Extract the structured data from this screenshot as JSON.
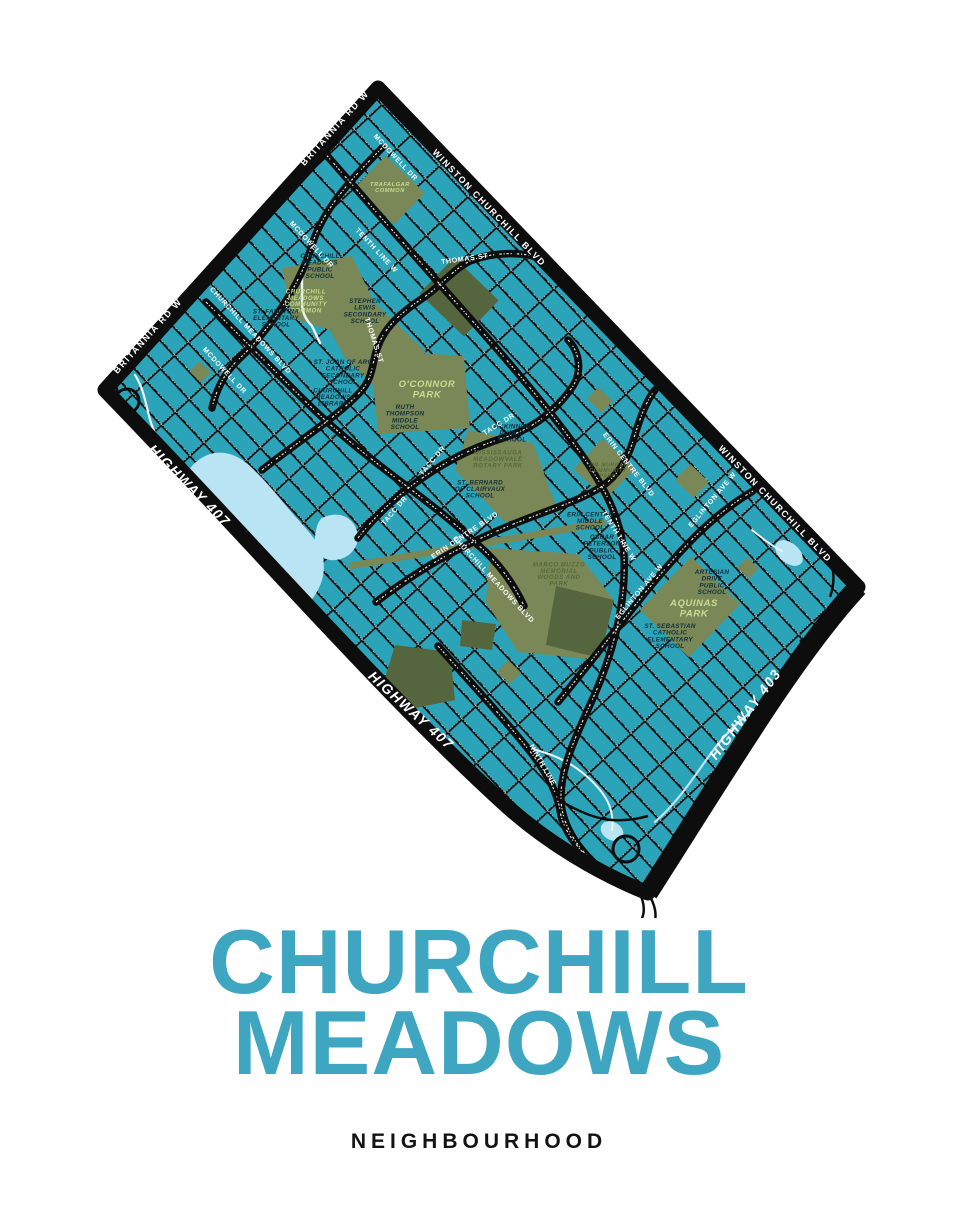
{
  "poster": {
    "title_line1": "CHURCHILL",
    "title_line2": "MEADOWS",
    "subtitle": "NEIGHBOURHOOD"
  },
  "colors": {
    "page_bg": "#FFFFFF",
    "map_water_teal": "#2BA4BA",
    "road_black": "#0D0D0D",
    "park_olive": "#7A8857",
    "park_dark_olive": "#55663E",
    "pond_light_blue": "#B9E4F4",
    "creek_white": "#EAF6FA",
    "street_label_white": "#FFFFFF",
    "school_label_dark": "#10303B",
    "park_label_light": "#C9DC8F",
    "park_label_dark": "#566A34",
    "title_teal": "#3EA6C1",
    "subtitle_black": "#121212"
  },
  "map": {
    "highway_labels": [
      {
        "text": "HIGHWAY 407",
        "x": 186,
        "y": 489,
        "rot": 45,
        "size": 14
      },
      {
        "text": "HIGHWAY 407",
        "x": 408,
        "y": 714,
        "rot": 42,
        "size": 14
      },
      {
        "text": "HIGHWAY 403",
        "x": 749,
        "y": 717,
        "rot": -53,
        "size": 14
      }
    ],
    "boundary_labels": [
      {
        "text": "BRITANNIA RD W",
        "x": 337,
        "y": 130,
        "rot": -48,
        "size": 9
      },
      {
        "text": "BRITANNIA RD W",
        "x": 150,
        "y": 338,
        "rot": -48,
        "size": 9
      },
      {
        "text": "WINSTON CHURCHILL BLVD",
        "x": 487,
        "y": 210,
        "rot": 46,
        "size": 9
      },
      {
        "text": "WINSTON CHURCHILL BLVD",
        "x": 773,
        "y": 506,
        "rot": 46,
        "size": 9
      }
    ],
    "street_labels": [
      {
        "text": "THOMAS ST",
        "x": 465,
        "y": 261,
        "rot": -8,
        "size": 7
      },
      {
        "text": "THOMAS ST",
        "x": 372,
        "y": 341,
        "rot": 72,
        "size": 7
      },
      {
        "text": "MCDOWELL DR",
        "x": 394,
        "y": 159,
        "rot": 47,
        "size": 7
      },
      {
        "text": "MCDOWELL DR",
        "x": 310,
        "y": 246,
        "rot": 47,
        "size": 7
      },
      {
        "text": "MCDOWELL DR",
        "x": 223,
        "y": 372,
        "rot": 47,
        "size": 7
      },
      {
        "text": "TENTH LINE W",
        "x": 375,
        "y": 252,
        "rot": 47,
        "size": 7
      },
      {
        "text": "TENTH LINE W",
        "x": 617,
        "y": 537,
        "rot": 58,
        "size": 7
      },
      {
        "text": "NINTH LINE",
        "x": 541,
        "y": 766,
        "rot": 60,
        "size": 7
      },
      {
        "text": "TACC DR",
        "x": 500,
        "y": 426,
        "rot": -32,
        "size": 7
      },
      {
        "text": "TACC DR",
        "x": 434,
        "y": 462,
        "rot": -50,
        "size": 7
      },
      {
        "text": "TACC DR",
        "x": 396,
        "y": 512,
        "rot": -50,
        "size": 7
      },
      {
        "text": "ERIN CENTRE BLVD",
        "x": 466,
        "y": 537,
        "rot": -34,
        "size": 7
      },
      {
        "text": "ERIN CENTRE BLVD",
        "x": 627,
        "y": 466,
        "rot": 52,
        "size": 7
      },
      {
        "text": "CHURCHILL MEADOWS BLVD",
        "x": 249,
        "y": 332,
        "rot": 47,
        "size": 7
      },
      {
        "text": "CHURCHILL MEADOWS BLVD",
        "x": 492,
        "y": 581,
        "rot": 47,
        "size": 7
      },
      {
        "text": "EGLINTON AVE W",
        "x": 714,
        "y": 501,
        "rot": -50,
        "size": 7
      },
      {
        "text": "EGLINTON AVE W",
        "x": 641,
        "y": 593,
        "rot": -50,
        "size": 7
      }
    ],
    "school_labels": [
      {
        "lines": [
          "CHURCHILL",
          "MEADOWS",
          "PUBLIC",
          "SCHOOL"
        ],
        "x": 320,
        "y": 268
      },
      {
        "lines": [
          "ST. FAUSTINA",
          "ELEMENTARY",
          "SCHOOL"
        ],
        "x": 276,
        "y": 320
      },
      {
        "lines": [
          "STEPHEN",
          "LEWIS",
          "SECONDARY",
          "SCHOOL"
        ],
        "x": 365,
        "y": 313
      },
      {
        "lines": [
          "ST. JOAN OF ARC",
          "CATHOLIC",
          "SECONDARY",
          "SCHOOL"
        ],
        "x": 343,
        "y": 374
      },
      {
        "lines": [
          "CHURCHILL",
          "MEADOWS",
          "LIBRARY"
        ],
        "x": 333,
        "y": 399
      },
      {
        "lines": [
          "RUTH",
          "THOMPSON",
          "MIDDLE",
          "SCHOOL"
        ],
        "x": 405,
        "y": 419
      },
      {
        "lines": [
          "MCKINNON",
          "PUBLIC",
          "SCHOOL"
        ],
        "x": 512,
        "y": 435
      },
      {
        "lines": [
          "ST. BERNARD",
          "OF CLAIRVAUX",
          "SCHOOL"
        ],
        "x": 480,
        "y": 491
      },
      {
        "lines": [
          "ERIN CENTRE",
          "MIDDLE",
          "SCHOOL"
        ],
        "x": 590,
        "y": 523
      },
      {
        "lines": [
          "OSCAR",
          "PETERSON",
          "PUBLIC",
          "SCHOOL"
        ],
        "x": 602,
        "y": 549
      },
      {
        "lines": [
          "ARTESIAN",
          "DRIVE",
          "PUBLIC",
          "SCHOOL"
        ],
        "x": 712,
        "y": 584
      },
      {
        "lines": [
          "ST. SEBASTIAN",
          "CATHOLIC",
          "ELEMENTARY",
          "SCHOOL"
        ],
        "x": 670,
        "y": 638
      }
    ],
    "park_labels": [
      {
        "lines": [
          "TRAFALGAR",
          "COMMON"
        ],
        "x": 390,
        "y": 189,
        "size": 5.6,
        "lh": 6,
        "color": "park_label_light"
      },
      {
        "lines": [
          "CHURCHILL",
          "MEADOWS",
          "COMMUNITY",
          "COMMON"
        ],
        "x": 306,
        "y": 303,
        "size": 6,
        "lh": 6.4,
        "color": "park_label_light"
      },
      {
        "lines": [
          "O'CONNOR",
          "PARK"
        ],
        "x": 427,
        "y": 392,
        "size": 9.5,
        "lh": 10.5,
        "color": "park_label_light"
      },
      {
        "lines": [
          "MISSISSAUGA",
          "MEADOWVALE",
          "ROTARY PARK"
        ],
        "x": 498,
        "y": 461,
        "size": 6,
        "lh": 6.4,
        "color": "park_label_dark"
      },
      {
        "lines": [
          "JIM MURRAY",
          "COMMUNITY",
          "PARK"
        ],
        "x": 608,
        "y": 472,
        "size": 5.2,
        "lh": 5.6,
        "color": "park_label_dark"
      },
      {
        "lines": [
          "MARCO MUZZO",
          "MEMORIAL",
          "WOODS AND",
          "PARK"
        ],
        "x": 559,
        "y": 576,
        "size": 6,
        "lh": 6.4,
        "color": "park_label_dark"
      },
      {
        "lines": [
          "AQUINAS",
          "PARK"
        ],
        "x": 694,
        "y": 611,
        "size": 9.5,
        "lh": 10.5,
        "color": "park_label_light"
      }
    ]
  }
}
